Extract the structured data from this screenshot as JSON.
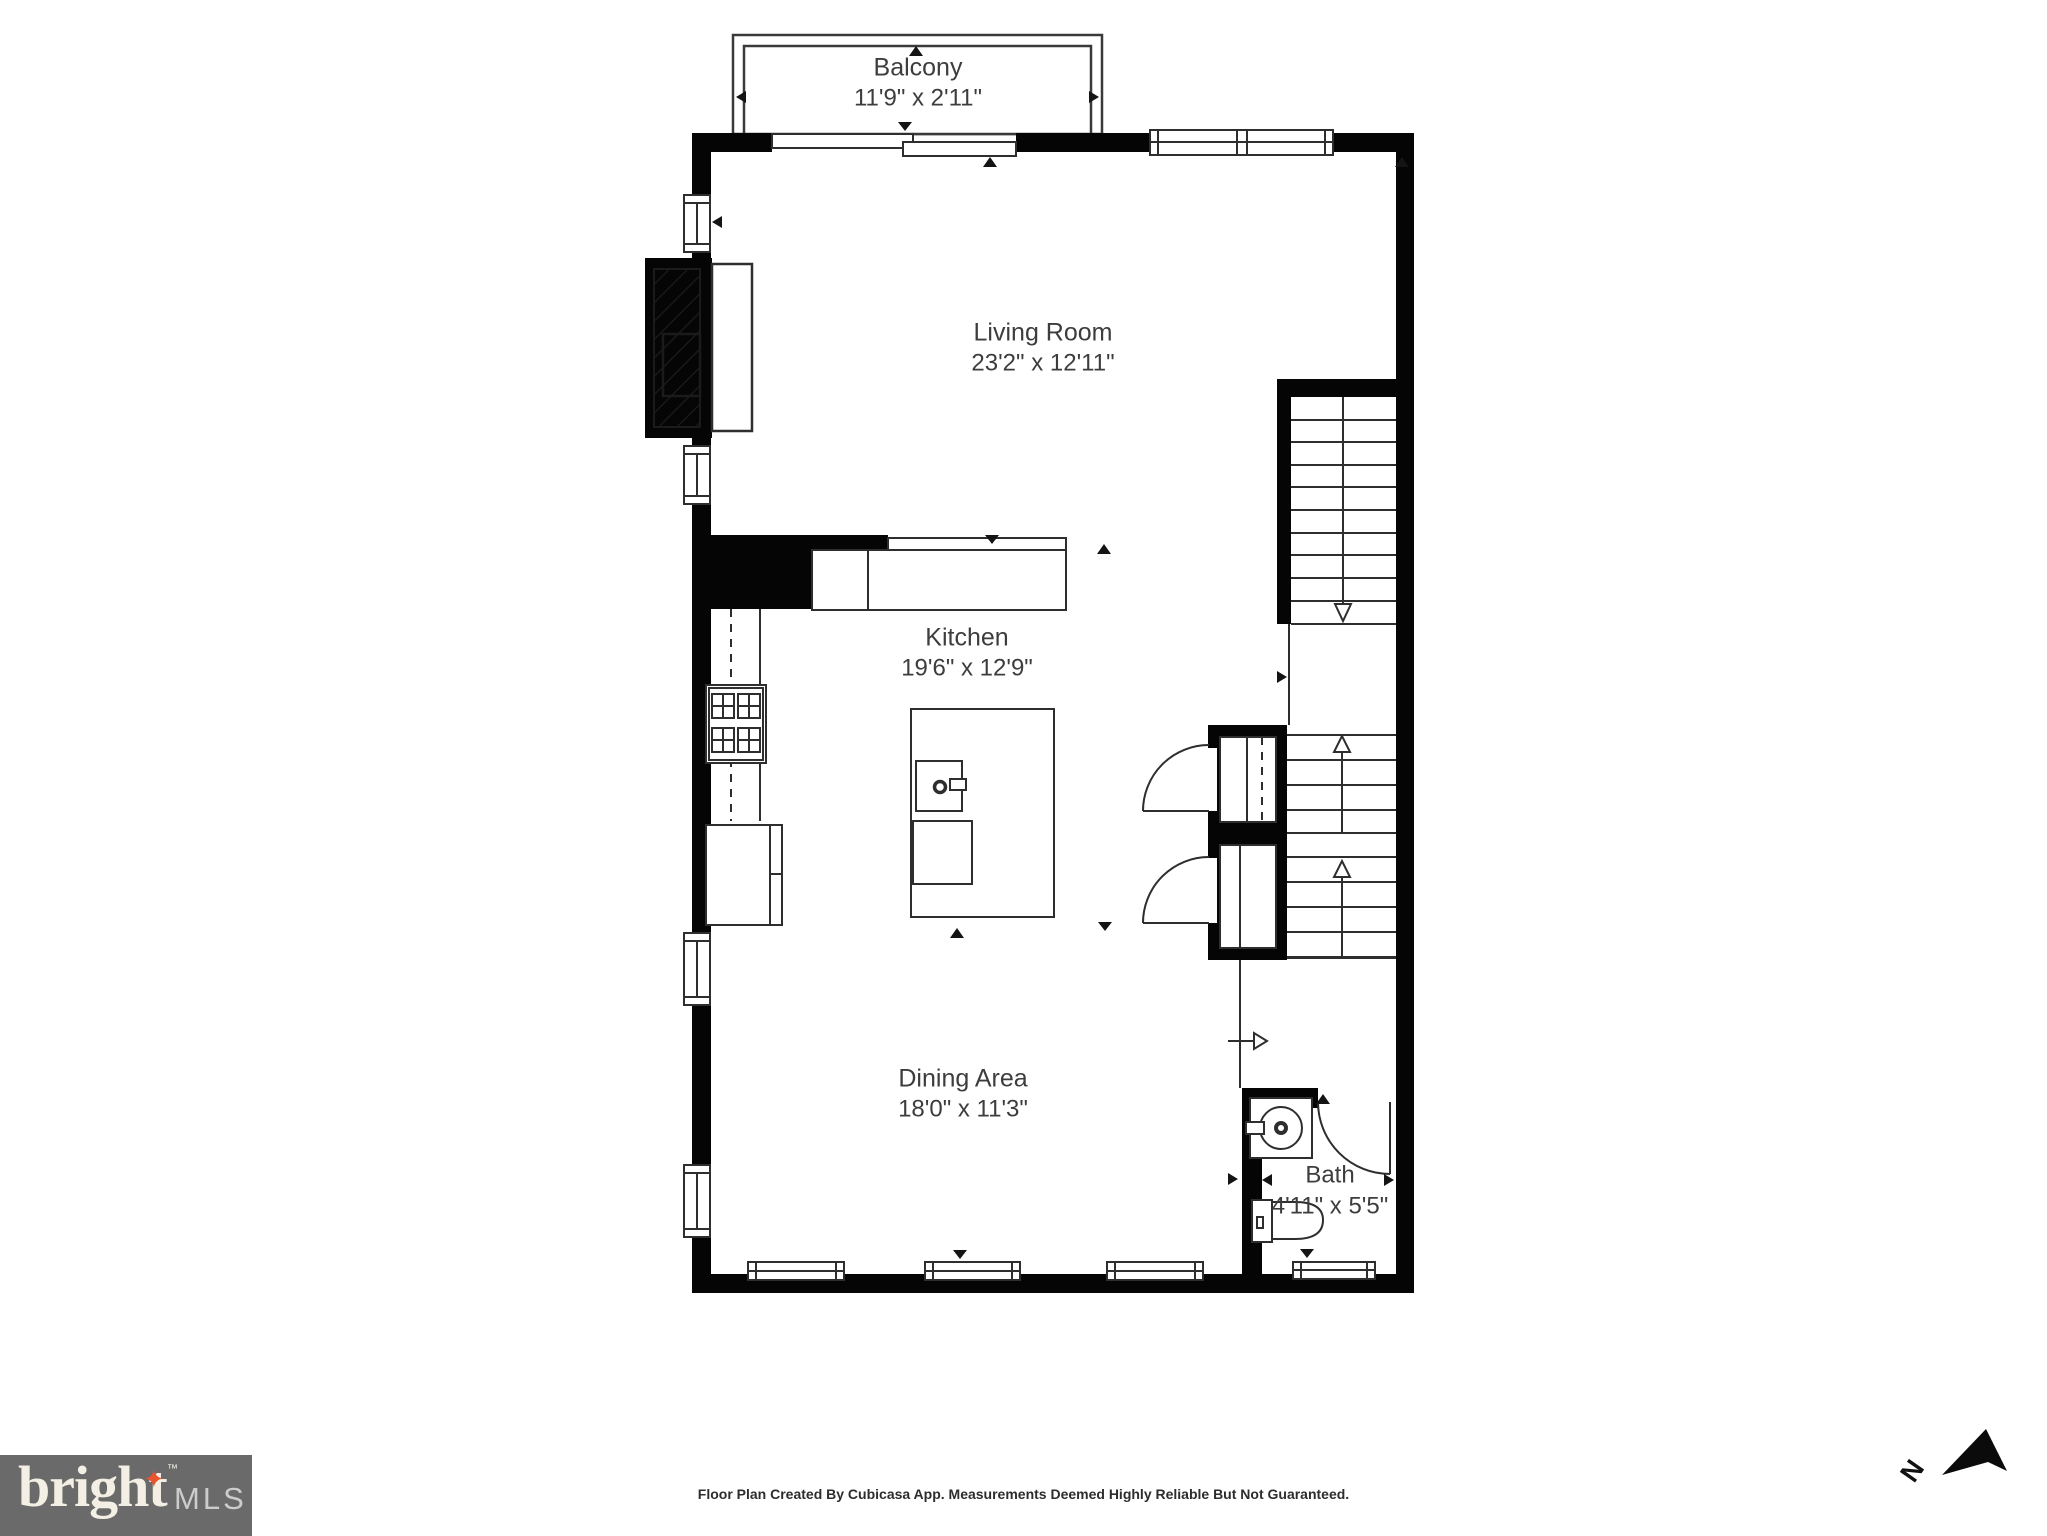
{
  "rooms": {
    "balcony": {
      "name": "Balcony",
      "dims": "11'9\" x 2'11\""
    },
    "living_room": {
      "name": "Living Room",
      "dims": "23'2\" x 12'11\""
    },
    "kitchen": {
      "name": "Kitchen",
      "dims": "19'6\" x 12'9\""
    },
    "dining_area": {
      "name": "Dining Area",
      "dims": "18'0\" x 11'3\""
    },
    "bath": {
      "name": "Bath",
      "dims": "4'11\" x 5'5\""
    }
  },
  "footer": {
    "credit": "Floor Plan Created By Cubicasa App. Measurements Deemed Highly Reliable But Not Guaranteed."
  },
  "branding": {
    "name": "bright",
    "suffix": "MLS",
    "trademark": "™",
    "star_glyph": "✦"
  },
  "compass": {
    "north_label": "N"
  },
  "colors": {
    "wall": "#050505",
    "line": "#2e2e2e",
    "room_text": "#3d3d3d",
    "logo_background": "#6a6a6a",
    "logo_star": "#e8542e",
    "logo_name": "#f4efe4",
    "logo_suffix": "#cccccc"
  }
}
